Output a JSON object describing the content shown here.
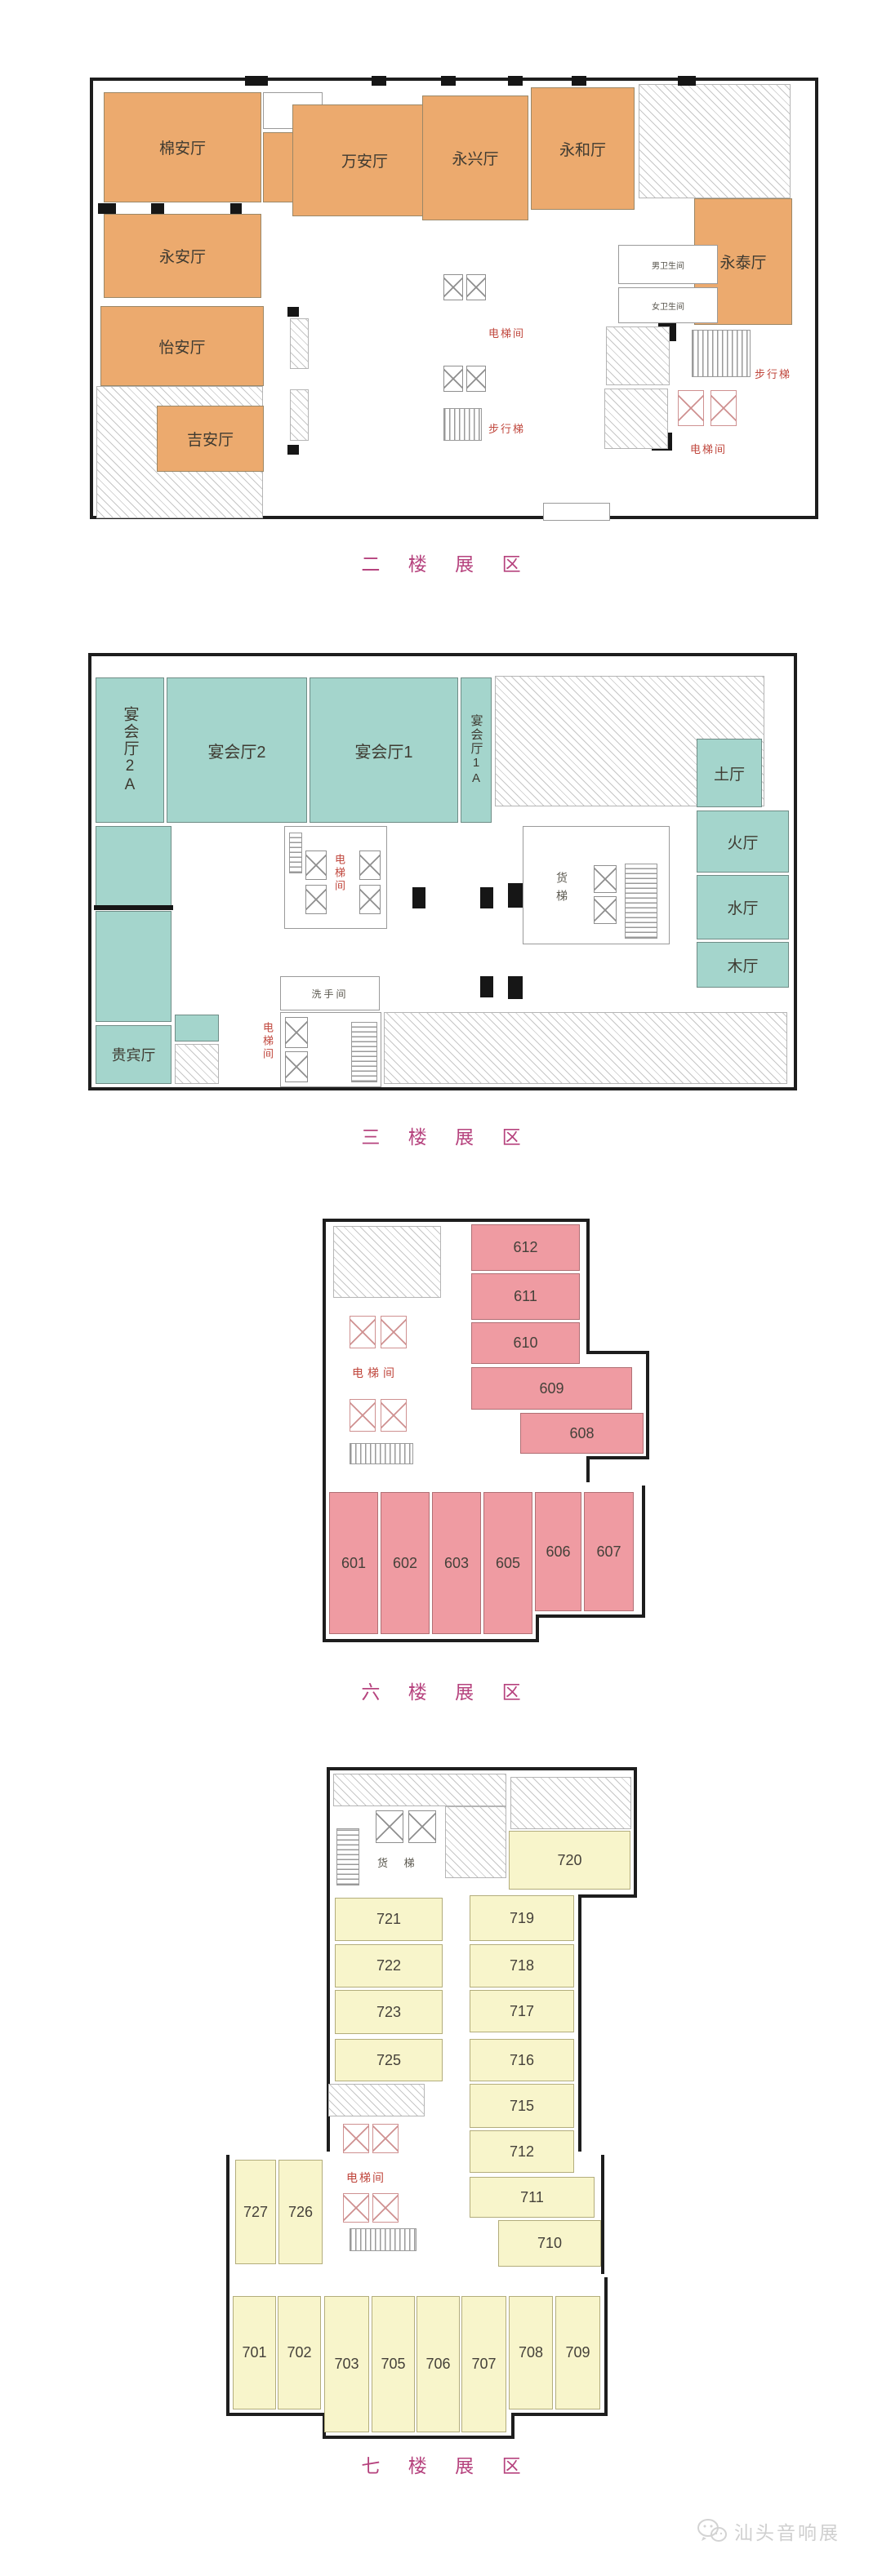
{
  "colors": {
    "orange": "#ecaa6e",
    "teal": "#a4d5cc",
    "pink": "#ef9ba2",
    "yellow": "#f8f5cb",
    "title": "#b6437e",
    "red_label": "#c0473d",
    "wall": "#1d1d1d",
    "watermark": "#cfcfcf"
  },
  "titles": {
    "floor2": "二 楼 展 区",
    "floor3": "三 楼 展 区",
    "floor6": "六 楼 展 区",
    "floor7": "七 楼 展 区"
  },
  "floor2": {
    "rooms": {
      "mian_an": "棉安厅",
      "yong_an": "永安厅",
      "yi_an": "怡安厅",
      "ji_an": "吉安厅",
      "wan_an": "万安厅",
      "yong_xing": "永兴厅",
      "yong_he": "永和厅",
      "yong_tai": "永泰厅"
    },
    "labels": {
      "elevator": "电梯间",
      "stairs": "步行梯",
      "male_wc": "男卫生间",
      "female_wc": "女卫生间"
    }
  },
  "floor3": {
    "rooms": {
      "banquet_2a": "宴会厅2A",
      "banquet_2": "宴会厅2",
      "banquet_1": "宴会厅1",
      "banquet_1a": "宴会厅1A",
      "earth": "土厅",
      "fire": "火厅",
      "water": "水厅",
      "wood": "木厅",
      "vip": "贵宾厅"
    },
    "labels": {
      "elevator": "电梯间",
      "freight": "货梯",
      "washroom": "洗手间"
    }
  },
  "floor6": {
    "rooms": {
      "r612": "612",
      "r611": "611",
      "r610": "610",
      "r609": "609",
      "r608": "608",
      "r601": "601",
      "r602": "602",
      "r603": "603",
      "r605": "605",
      "r606": "606",
      "r607": "607"
    },
    "labels": {
      "elevator": "电梯间"
    }
  },
  "floor7": {
    "rooms": {
      "r720": "720",
      "r721": "721",
      "r722": "722",
      "r723": "723",
      "r725": "725",
      "r719": "719",
      "r718": "718",
      "r717": "717",
      "r716": "716",
      "r715": "715",
      "r712": "712",
      "r711": "711",
      "r710": "710",
      "r727": "727",
      "r726": "726",
      "r701": "701",
      "r702": "702",
      "r703": "703",
      "r705": "705",
      "r706": "706",
      "r707": "707",
      "r708": "708",
      "r709": "709"
    },
    "labels": {
      "elevator": "电梯间",
      "freight": "货 梯"
    }
  },
  "watermark": {
    "text": "汕头音响展",
    "icon": "wechat-icon"
  }
}
